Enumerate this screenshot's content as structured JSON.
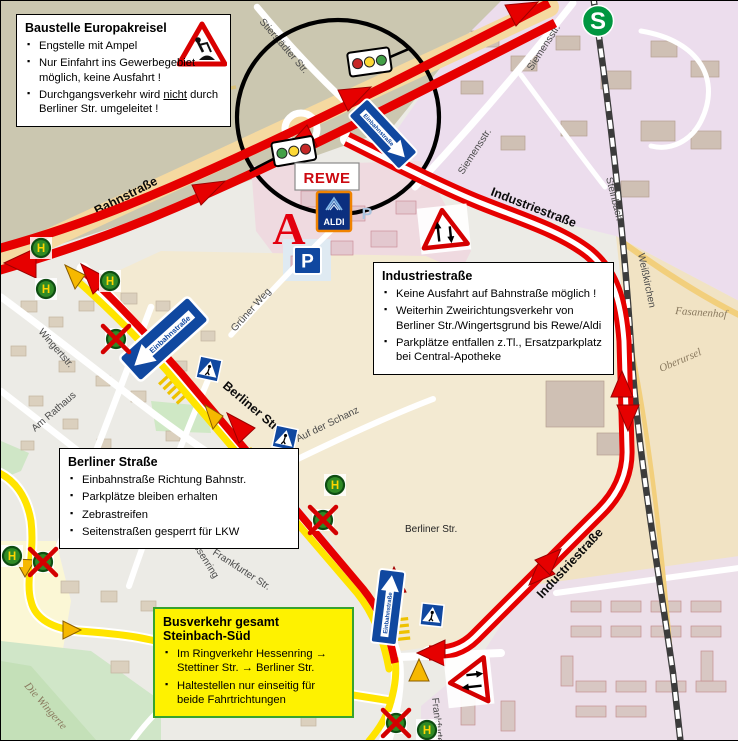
{
  "boxes": {
    "baustelle": {
      "title": "Baustelle Europakreisel",
      "bullets": [
        {
          "text": "Engstelle mit Ampel"
        },
        {
          "text": "Nur Einfahrt ins Gewerbegebiet möglich, keine Ausfahrt !"
        },
        {
          "pre": "Durchgangsverkehr wird ",
          "underline": "nicht",
          "post": " durch Berliner Str. umgeleitet !"
        }
      ]
    },
    "industriestrasse": {
      "title": "Industriestraße",
      "bullets": [
        {
          "text": "Keine Ausfahrt auf Bahnstraße möglich !"
        },
        {
          "text": "Weiterhin Zweirichtungsverkehr von Berliner Str./Wingertsgrund bis Rewe/Aldi"
        },
        {
          "text": "Parkplätze entfallen z.Tl., Ersatzparkplatz bei Central-Apotheke"
        }
      ]
    },
    "berliner": {
      "title": "Berliner Straße",
      "bullets": [
        {
          "text": "Einbahnstraße Richtung Bahnstr."
        },
        {
          "text": "Parkplätze bleiben erhalten"
        },
        {
          "text": "Zebrastreifen"
        },
        {
          "text": "Seitenstraßen gesperrt für LKW"
        }
      ]
    },
    "busverkehr": {
      "title": "Busverkehr gesamt Steinbach-Süd",
      "bullets": [
        {
          "text": "Im Ringverkehr Hessenring → Stettiner Str. → Berliner Str."
        },
        {
          "text": "Haltestellen nur einseitig für beide Fahrtrichtungen"
        }
      ]
    }
  },
  "map_labels": [
    {
      "text": "Bahnstraße"
    },
    {
      "text": "Industriestraße"
    },
    {
      "text": "Industriestraße"
    },
    {
      "text": "Berliner Str."
    },
    {
      "text": "Berliner Str."
    },
    {
      "text": "Grüner Weg"
    },
    {
      "text": "Auf der Schanz"
    },
    {
      "text": "Wingertstr."
    },
    {
      "text": "Am Rathaus"
    },
    {
      "text": "Frankfurter Str."
    },
    {
      "text": "Hessenring"
    },
    {
      "text": "Frankfurter Str."
    },
    {
      "text": "Siemensstr."
    },
    {
      "text": "Siemensstr."
    },
    {
      "text": "Stierstädter Str."
    },
    {
      "text": "Steinbach"
    },
    {
      "text": "Weißkirchen"
    },
    {
      "text": "Fasanenhof"
    },
    {
      "text": "Oberursel"
    },
    {
      "text": "Die Wingerte"
    }
  ],
  "logos": {
    "rewe": "REWE",
    "aldi": "ALDI",
    "apotheke": "A",
    "parking": "P",
    "parking_map": "P",
    "sbahn": "S",
    "bus_stop": "H"
  },
  "signs": {
    "einbahn": "Einbahnstraße"
  },
  "colors": {
    "route_red": "#e60000",
    "route_yellow": "#ffe400",
    "bus_stop_green": "#2f8a25",
    "bus_stop_letter": "#ffd500",
    "closed_x_red": "#d40000",
    "info_box_yellow": "#fef200",
    "info_box_green_border": "#38a32e",
    "sign_blue": "#1048a0",
    "sbahn_green": "#009640",
    "rewe_red": "#cc0a11",
    "aldi_blue": "#0b2f7f"
  }
}
